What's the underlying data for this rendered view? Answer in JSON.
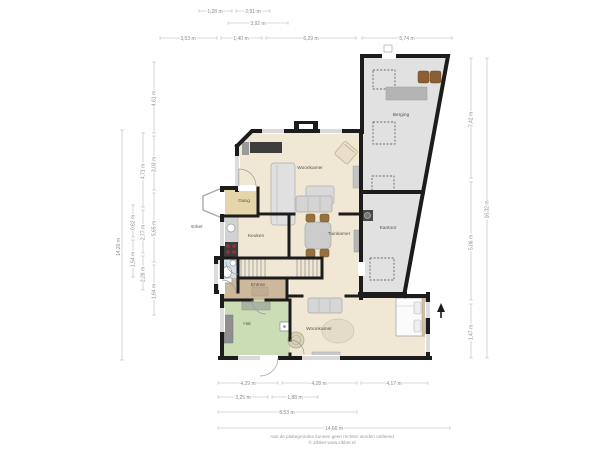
{
  "plan": {
    "type": "floorplan-first-floor",
    "north_arrow": "▲"
  },
  "rooms": {
    "woonkamer_top": "Woonkamer",
    "berging": "Berging",
    "kantoor": "Kantoor",
    "tuinkamer": "Tuinkamer",
    "keuken": "Keuken",
    "gang": "Gang",
    "entree": "Entree",
    "hal": "Hal",
    "woonkamer_bottom": "Woonkamer",
    "erker": "Erker"
  },
  "dimensions": {
    "top_row1": [
      "1,28 m",
      "2,91 m"
    ],
    "top_row2": [
      "3,92 m"
    ],
    "top_row3": [
      "3,53 m",
      "1,40 m",
      "6,29 m",
      "5,74 m"
    ],
    "left_outer": "14,20 m",
    "left_col2": [
      "0,62 m",
      "1,54 m"
    ],
    "left_col3": [
      "4,71 m",
      "2,77 m",
      "2,28 m"
    ],
    "left_col4": [
      "4,61 m",
      "3,03 m",
      "5,65 m",
      "1,64 m"
    ],
    "right_col1": [
      "7,42 m",
      "5,06 m",
      "1,47 m"
    ],
    "right_outer": "16,32 m",
    "bottom_row1": [
      "4,29 m",
      "4,28 m",
      "4,17 m"
    ],
    "bottom_row2": [
      "3,25 m",
      "1,88 m"
    ],
    "bottom_row3": [
      "8,53 m"
    ],
    "bottom_row4": [
      "14,66 m"
    ]
  },
  "footer": {
    "line1": "Aan de plattegronden kunnen geen rechten worden ontleend",
    "line2": "© Zibber www.zibber.nl"
  },
  "colors": {
    "wall": "#1c1c1c",
    "floor_beige": "#f0e8d5",
    "floor_tan": "#e6d5ab",
    "floor_gray": "#e1e1e1",
    "floor_green": "#cbddb4",
    "floor_blue": "#d2e2e9",
    "floor_wood": "#cdb89c",
    "dim_line": "#b8b8b8",
    "dim_text": "#8a8a8a"
  }
}
